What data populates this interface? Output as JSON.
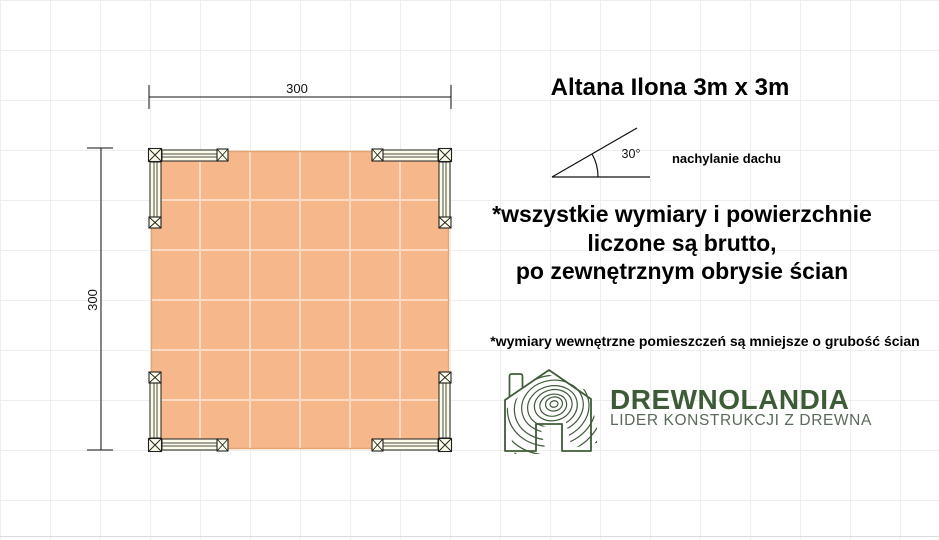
{
  "title": "Altana Ilona 3m x 3m",
  "dimensions": {
    "width_cm": "300",
    "height_cm": "300"
  },
  "roof_pitch": {
    "angle": "30°",
    "caption": "nachylanie dachu"
  },
  "notes": {
    "gross_line1": "*wszystkie wymiary i powierzchnie",
    "gross_line2": "liczone są brutto,",
    "gross_line3": "po zewnętrznym obrysie ścian",
    "internal": "*wymiary wewnętrzne pomieszczeń są mniejsze o grubość ścian"
  },
  "logo": {
    "brand": "DREWNOLANDIA",
    "tagline": "LIDER KONSTRUKCJI Z DREWNA",
    "icon": "wood-rings-house-icon"
  },
  "colors": {
    "floor_fill": "#f6b78b",
    "timber_fill": "#fcfce9",
    "brand_green": "#3c5b36",
    "tagline_green": "#5a6a5a",
    "line_black": "#111111"
  }
}
